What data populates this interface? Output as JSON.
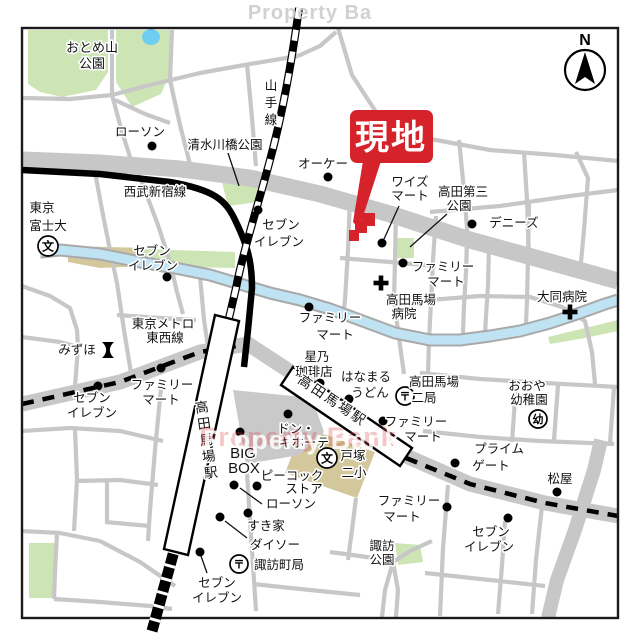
{
  "map": {
    "canvas": {
      "w": 640,
      "h": 640,
      "bg": "#ffffff"
    },
    "frame": {
      "x": 22,
      "y": 28,
      "w": 596,
      "h": 590,
      "stroke": "#1a1a1a",
      "sw": 2.4
    },
    "colors": {
      "road": "#c7c7c7",
      "park": "#cde4b5",
      "pond": "#6ecef2",
      "water": "#bfe3f2",
      "water_casing": "#a9a9a9",
      "tan": "#d2c89c",
      "plaza": "#c9c9c9",
      "rail": "#000000",
      "site_red": "#d6232b",
      "text": "#111111",
      "watermark_gray": "#c9c9c9",
      "watermark_red": "#e0474d"
    },
    "watermarks": {
      "top": "Property Ba",
      "center": "Property Bank"
    },
    "compass": {
      "label": "N",
      "cx": 585,
      "cy": 70,
      "r": 20,
      "arrow": "585,52 595,84 585,77 575,84",
      "label_y": 45
    },
    "parks": [
      {
        "name": "otomeyama-park-west",
        "pts": "28,30 108,30 108,72 96,90 62,97 40,92 28,84"
      },
      {
        "name": "otomeyama-park-east",
        "pts": "116,30 172,30 172,68 161,94 132,107 116,82"
      },
      {
        "name": "shimizugawabashi-park",
        "pts": "222,182 256,178 258,202 228,206"
      },
      {
        "name": "takada-daisan-park",
        "pts": "394,238 414,238 414,258 394,258"
      },
      {
        "name": "suwa-park",
        "pts": "395,543 420,545 423,562 398,565"
      },
      {
        "name": "southwest-green",
        "pts": "29,543 56,543 56,598 29,598"
      },
      {
        "name": "river-bank-green-west",
        "pts": "143,249 235,252 235,268 143,266"
      },
      {
        "name": "river-bank-green-east",
        "pts": "548,337 585,328 618,320 618,331 585,338 550,344"
      }
    ],
    "tans": [
      {
        "name": "tokyo-fuji-univ-grounds",
        "pts": "68,246 145,248 145,266 100,268 68,262"
      },
      {
        "name": "tozuka-school-grounds",
        "pts": "303,427 375,452 357,498 285,473"
      }
    ],
    "pond": {
      "name": "otomeyama-pond",
      "cx": 151,
      "cy": 37,
      "rx": 9,
      "ry": 8
    },
    "plaza": {
      "name": "station-plaza",
      "pts": "233,390 312,398 324,432 300,455 246,464"
    },
    "roads_major": [
      {
        "name": "road-mejiro-dori",
        "pts": "22,160 100,163 180,169 250,178 320,194 390,214 470,240 550,262 618,281",
        "w": 17
      },
      {
        "name": "road-waseda-dori",
        "pts": "22,404 120,382 200,352 248,344 300,378 355,416 406,456 470,484 545,503 618,516",
        "w": 15
      },
      {
        "name": "road-east-vertical",
        "pts": "601,440 594,470 575,530 557,580 548,618",
        "w": 14
      }
    ],
    "roads_minor": [
      {
        "pts": "22,98 70,99 112,95 150,85 200,73 250,64 298,56"
      },
      {
        "pts": "112,30 112,95 122,132 133,166"
      },
      {
        "pts": "172,30 170,80 180,125 192,172"
      },
      {
        "pts": "115,100 145,114 170,123"
      },
      {
        "pts": "247,64 252,118 256,166"
      },
      {
        "pts": "298,56 320,46 336,32"
      },
      {
        "pts": "338,28 352,75 376,112 425,138 490,150 555,155 618,161"
      },
      {
        "pts": "459,140 464,190 468,240"
      },
      {
        "pts": "524,152 527,200 529,258"
      },
      {
        "pts": "430,212 500,206 570,196 618,190"
      },
      {
        "pts": "576,152 588,178 584,230 581,262"
      },
      {
        "pts": "95,172 103,215 110,250 117,283 124,330 133,385"
      },
      {
        "pts": "138,172 158,225 170,262 177,292 183,314"
      },
      {
        "pts": "117,315 160,318 196,320"
      },
      {
        "pts": "200,276 204,320 210,360 216,390"
      },
      {
        "pts": "22,286 50,296 70,308 77,330 78,347"
      },
      {
        "pts": "22,337 60,342 78,347"
      },
      {
        "pts": "78,347 74,400"
      },
      {
        "pts": "350,198 348,250 345,300 343,316"
      },
      {
        "pts": "396,210 395,260 394,300 399,338 404,374"
      },
      {
        "pts": "436,216 433,260 431,302 429,340 428,374"
      },
      {
        "pts": "467,240 466,272 464,305 463,333"
      },
      {
        "pts": "489,248 488,285 486,316 485,334"
      },
      {
        "pts": "529,200 528,256 527,300 526,324"
      },
      {
        "pts": "340,258 390,262 436,266"
      },
      {
        "pts": "430,300 480,296 530,297 562,307 585,321 592,352 595,384"
      },
      {
        "pts": "420,373 480,379 545,383 618,387"
      },
      {
        "pts": "516,385 512,442"
      },
      {
        "pts": "558,385 554,440"
      },
      {
        "pts": "423,431 480,437 540,441 614,444"
      },
      {
        "pts": "614,388 610,443"
      },
      {
        "pts": "448,485 443,548 440,616"
      },
      {
        "pts": "505,521 502,565 498,614"
      },
      {
        "pts": "425,573 490,580 545,586"
      },
      {
        "pts": "542,506 536,560 532,614"
      },
      {
        "pts": "330,552 360,556 392,561"
      },
      {
        "pts": "432,541 410,551 393,562 385,590 382,617"
      },
      {
        "pts": "393,562 398,590 396,617"
      },
      {
        "pts": "22,431 70,428 120,431 163,441"
      },
      {
        "pts": "75,429 77,480 74,531"
      },
      {
        "pts": "76,481 120,480 158,485"
      },
      {
        "pts": "107,481 107,522"
      },
      {
        "pts": "105,522 150,526"
      },
      {
        "pts": "22,531 60,533 100,541"
      },
      {
        "pts": "100,541 140,562 175,586"
      },
      {
        "pts": "57,533 55,572 54,599"
      },
      {
        "pts": "54,599 100,602 150,606 172,609"
      },
      {
        "pts": "161,388 155,450 150,510 148,541"
      },
      {
        "pts": "247,472 250,520 253,565 256,611"
      },
      {
        "pts": "253,584 310,590 360,595"
      },
      {
        "pts": "356,498 352,530 348,560"
      }
    ],
    "river": {
      "name": "kanda-river",
      "pts": "40,252 60,250 100,254 140,262 180,269 210,275 240,284 270,293 300,300 330,309 360,320 395,333 430,340 460,340 490,336 520,331 550,323 580,313 605,304 618,300",
      "w_fill": 9,
      "w_casing": 13
    },
    "rails": {
      "seibu": {
        "name": "seibu-shinjuku-line",
        "path": "M22,170 L100,174 L170,182 C215,190 226,200 236,222 C248,247 252,262 252,288 L248,330 L244,367",
        "w": 6.5
      },
      "yamanote": {
        "name": "yamanote-line",
        "path": "M299,8 C292,60 283,112 270,160 C258,205 243,252 236,288 L229,318",
        "w": 8
      },
      "platform": {
        "name": "jr-platform",
        "path": "M174,551 L152,631",
        "w": 11
      },
      "tozai_dashes": [
        "M22,404 L120,382 L200,352 L243,345",
        "M406,458 L470,484 L545,503 L618,516"
      ]
    },
    "stations": {
      "jr_box": {
        "name": "jr-takadanobaba-station",
        "pts": "215,315 239,321 188,555 164,549"
      },
      "tozai_box": {
        "name": "tozai-takadanobaba-station",
        "pts": "281,385 293,367 412,448 400,466"
      },
      "jr_label": {
        "name": "jr-station-label",
        "text": "高田馬場駅",
        "x": 201,
        "y0": 412,
        "dy": 16.5,
        "rot": [
          -8,
          201,
          402
        ],
        "s": 13.5
      },
      "tozai_label": {
        "name": "tozai-station-label",
        "text": "高田馬場駅",
        "x": 297,
        "y": 382,
        "rot": [
          34,
          297,
          382
        ],
        "ls": 2.5,
        "s": 13.5
      }
    },
    "site": {
      "label": "現地",
      "balloon": {
        "x": 350,
        "y": 110,
        "w": 83,
        "h": 53,
        "r": 7
      },
      "text_pos": [
        391,
        149
      ],
      "pointer": "363,161 381,161 359,229 353,222",
      "footprint": "M375,213 L375,226 L367,226 L367,233 L359,233 L359,241 L349,241 L349,230 L355,230 L355,221 L362,221 L362,213 Z"
    },
    "leaders": [
      {
        "name": "leader-shimizugawabashi",
        "x1": 228,
        "y1": 153,
        "x2": 239,
        "y2": 186
      },
      {
        "name": "leader-takada-daisan",
        "x1": 447,
        "y1": 214,
        "x2": 410,
        "y2": 247
      },
      {
        "name": "leader-ys-mart",
        "x1": 399,
        "y1": 206,
        "x2": 384,
        "y2": 239
      },
      {
        "name": "leader-lawson-south",
        "x1": 262,
        "y1": 504,
        "x2": 240,
        "y2": 488
      },
      {
        "name": "leader-daiso",
        "x1": 225,
        "y1": 521,
        "x2": 247,
        "y2": 538
      },
      {
        "name": "leader-seven-south",
        "x1": 201,
        "y1": 556,
        "x2": 207,
        "y2": 573
      }
    ],
    "dots": [
      {
        "name": "poi-lawson-north",
        "x": 152,
        "y": 146
      },
      {
        "name": "poi-ok-store",
        "x": 328,
        "y": 177
      },
      {
        "name": "poi-seven-eleven-mid",
        "x": 258,
        "y": 210
      },
      {
        "name": "poi-dennys",
        "x": 472,
        "y": 224
      },
      {
        "name": "poi-ys-mart",
        "x": 382,
        "y": 243
      },
      {
        "name": "poi-familymart-ne",
        "x": 403,
        "y": 263
      },
      {
        "name": "poi-seven-eleven-west",
        "x": 167,
        "y": 277
      },
      {
        "name": "poi-familymart-river",
        "x": 309,
        "y": 307
      },
      {
        "name": "poi-familymart-west",
        "x": 161,
        "y": 368
      },
      {
        "name": "poi-seven-eleven-sw",
        "x": 98,
        "y": 386
      },
      {
        "name": "poi-hoshino-coffee",
        "x": 320,
        "y": 383
      },
      {
        "name": "poi-hanamaru-udon",
        "x": 349,
        "y": 399
      },
      {
        "name": "poi-don-quijote",
        "x": 288,
        "y": 414
      },
      {
        "name": "poi-familymart-mid",
        "x": 383,
        "y": 421
      },
      {
        "name": "poi-big-box",
        "x": 240,
        "y": 432
      },
      {
        "name": "poi-prime-gate",
        "x": 455,
        "y": 463
      },
      {
        "name": "poi-lawson-south",
        "x": 234,
        "y": 485
      },
      {
        "name": "poi-peacock-store",
        "x": 257,
        "y": 486
      },
      {
        "name": "poi-familymart-se",
        "x": 447,
        "y": 507
      },
      {
        "name": "poi-sukiya",
        "x": 248,
        "y": 513
      },
      {
        "name": "poi-daiso",
        "x": 220,
        "y": 517
      },
      {
        "name": "poi-matsuya",
        "x": 557,
        "y": 492
      },
      {
        "name": "poi-seven-eleven-se",
        "x": 508,
        "y": 518
      },
      {
        "name": "poi-seven-eleven-south",
        "x": 200,
        "y": 552
      }
    ],
    "symbols": [
      {
        "type": "school",
        "name": "tokyo-fuji-univ-icon",
        "x": 48,
        "y": 246,
        "r": 10,
        "ch": "文"
      },
      {
        "type": "school",
        "name": "tozuka-elementary-icon",
        "x": 327,
        "y": 458,
        "r": 10,
        "ch": "文"
      },
      {
        "type": "post",
        "name": "takadanobaba-2-post-icon",
        "x": 405,
        "y": 396,
        "r": 9,
        "ch": "〒"
      },
      {
        "type": "post",
        "name": "suwacho-post-icon",
        "x": 239,
        "y": 564,
        "r": 9,
        "ch": "〒"
      },
      {
        "type": "kindergarten",
        "name": "ooya-kindergarten-icon",
        "x": 538,
        "y": 419,
        "r": 9,
        "ch": "幼"
      },
      {
        "type": "hospital",
        "name": "takadanobaba-hospital-icon",
        "x": 381,
        "y": 283
      },
      {
        "type": "hospital",
        "name": "daido-hospital-icon",
        "x": 570,
        "y": 312
      },
      {
        "type": "bank",
        "name": "mizuho-bank-icon",
        "x": 108,
        "y": 350
      }
    ],
    "labels": [
      {
        "name": "label-otomeyama-1",
        "text": "おとめ山",
        "x": 92,
        "y": 52,
        "s": 13
      },
      {
        "name": "label-otomeyama-2",
        "text": "公園",
        "x": 92,
        "y": 68,
        "s": 13
      },
      {
        "name": "label-lawson-north",
        "text": "ローソン",
        "x": 140,
        "y": 136
      },
      {
        "name": "label-shimizugawabashi",
        "text": "清水川橋公園",
        "x": 225,
        "y": 149
      },
      {
        "name": "label-yamanote-line",
        "text": "山手線",
        "x": 271,
        "y": 90,
        "vert": true,
        "dy": 17
      },
      {
        "name": "label-seibu-line",
        "text": "西武新宿線",
        "x": 155,
        "y": 196
      },
      {
        "name": "label-ok-store",
        "text": "オーケー",
        "x": 323,
        "y": 168
      },
      {
        "name": "label-ys-mart-1",
        "text": "ワイズ",
        "x": 410,
        "y": 186
      },
      {
        "name": "label-ys-mart-2",
        "text": "マート",
        "x": 410,
        "y": 200
      },
      {
        "name": "label-takada-daisan-1",
        "text": "高田第三",
        "x": 463,
        "y": 196
      },
      {
        "name": "label-takada-daisan-2",
        "text": "公園",
        "x": 459,
        "y": 210
      },
      {
        "name": "label-dennys",
        "text": "デニーズ",
        "x": 514,
        "y": 227
      },
      {
        "name": "label-seven-mid-1",
        "text": "セブン",
        "x": 281,
        "y": 229
      },
      {
        "name": "label-seven-mid-2",
        "text": "イレブン",
        "x": 279,
        "y": 246
      },
      {
        "name": "label-familymart-ne-1",
        "text": "ファミリー",
        "x": 443,
        "y": 271
      },
      {
        "name": "label-familymart-ne-2",
        "text": "マート",
        "x": 446,
        "y": 286
      },
      {
        "name": "label-baba-hospital-1",
        "text": "高田馬場",
        "x": 411,
        "y": 304
      },
      {
        "name": "label-baba-hospital-2",
        "text": "病院",
        "x": 404,
        "y": 318
      },
      {
        "name": "label-daido-hospital",
        "text": "大同病院",
        "x": 562,
        "y": 301
      },
      {
        "name": "label-tokyo-fuji-1",
        "text": "東京",
        "x": 42,
        "y": 212
      },
      {
        "name": "label-tokyo-fuji-2",
        "text": "富士大",
        "x": 48,
        "y": 230
      },
      {
        "name": "label-seven-west-1",
        "text": "セブン",
        "x": 152,
        "y": 255
      },
      {
        "name": "label-seven-west-2",
        "text": "イレブン",
        "x": 153,
        "y": 270
      },
      {
        "name": "label-tozai-line-1",
        "text": "東京メトロ",
        "x": 163,
        "y": 328
      },
      {
        "name": "label-tozai-line-2",
        "text": "東西線",
        "x": 165,
        "y": 342
      },
      {
        "name": "label-mizuho",
        "text": "みずほ",
        "x": 77,
        "y": 354
      },
      {
        "name": "label-familymart-river-1",
        "text": "ファミリー",
        "x": 330,
        "y": 322
      },
      {
        "name": "label-familymart-river-2",
        "text": "マート",
        "x": 335,
        "y": 339
      },
      {
        "name": "label-familymart-west-1",
        "text": "ファミリー",
        "x": 162,
        "y": 389
      },
      {
        "name": "label-familymart-west-2",
        "text": "マート",
        "x": 161,
        "y": 404
      },
      {
        "name": "label-seven-sw-1",
        "text": "セブン",
        "x": 92,
        "y": 402
      },
      {
        "name": "label-seven-sw-2",
        "text": "イレブン",
        "x": 92,
        "y": 417
      },
      {
        "name": "label-hoshino-1",
        "text": "星乃",
        "x": 317,
        "y": 361
      },
      {
        "name": "label-hoshino-2",
        "text": "珈琲店",
        "x": 314,
        "y": 376
      },
      {
        "name": "label-hanamaru-1",
        "text": "はなまる",
        "x": 366,
        "y": 381
      },
      {
        "name": "label-hanamaru-2",
        "text": "うどん",
        "x": 370,
        "y": 397
      },
      {
        "name": "label-baba2-post-1",
        "text": "高田馬場",
        "x": 434,
        "y": 386
      },
      {
        "name": "label-baba2-post-2",
        "text": "二局",
        "x": 424,
        "y": 402
      },
      {
        "name": "label-ooya-1",
        "text": "おおや",
        "x": 527,
        "y": 390
      },
      {
        "name": "label-ooya-2",
        "text": "幼稚園",
        "x": 529,
        "y": 404
      },
      {
        "name": "label-donki-1",
        "text": "ドン・",
        "x": 296,
        "y": 433
      },
      {
        "name": "label-donki-2",
        "text": "キホーテ",
        "x": 304,
        "y": 447
      },
      {
        "name": "label-bigbox-1",
        "text": "BIG",
        "x": 243,
        "y": 458,
        "s": 15
      },
      {
        "name": "label-bigbox-2",
        "text": "BOX",
        "x": 244,
        "y": 473,
        "s": 15
      },
      {
        "name": "label-peacock-1",
        "text": "ピーコック",
        "x": 292,
        "y": 480
      },
      {
        "name": "label-peacock-2",
        "text": "ストア",
        "x": 304,
        "y": 493
      },
      {
        "name": "label-lawson-south",
        "text": "ローソン",
        "x": 291,
        "y": 508
      },
      {
        "name": "label-sukiya",
        "text": "すき家",
        "x": 266,
        "y": 530
      },
      {
        "name": "label-daiso",
        "text": "ダイソー",
        "x": 275,
        "y": 549
      },
      {
        "name": "label-suwacho-post",
        "text": "諏訪町局",
        "x": 279,
        "y": 569
      },
      {
        "name": "label-seven-south-1",
        "text": "セブン",
        "x": 217,
        "y": 587
      },
      {
        "name": "label-seven-south-2",
        "text": "イレブン",
        "x": 217,
        "y": 602
      },
      {
        "name": "label-tozuka-1",
        "text": "戸塚",
        "x": 353,
        "y": 460
      },
      {
        "name": "label-tozuka-2",
        "text": "二小",
        "x": 354,
        "y": 477
      },
      {
        "name": "label-familymart-mid-1",
        "text": "ファミリー",
        "x": 416,
        "y": 426
      },
      {
        "name": "label-familymart-mid-2",
        "text": "マート",
        "x": 423,
        "y": 441
      },
      {
        "name": "label-prime-1",
        "text": "プライム",
        "x": 499,
        "y": 453
      },
      {
        "name": "label-prime-2",
        "text": "ゲート",
        "x": 491,
        "y": 470
      },
      {
        "name": "label-familymart-se-1",
        "text": "ファミリー",
        "x": 409,
        "y": 505
      },
      {
        "name": "label-familymart-se-2",
        "text": "マート",
        "x": 402,
        "y": 521
      },
      {
        "name": "label-seven-se-1",
        "text": "セブン",
        "x": 491,
        "y": 536
      },
      {
        "name": "label-seven-se-2",
        "text": "イレブン",
        "x": 489,
        "y": 551
      },
      {
        "name": "label-matsuya",
        "text": "松屋",
        "x": 560,
        "y": 483
      },
      {
        "name": "label-suwa-park-1",
        "text": "諏訪",
        "x": 382,
        "y": 550
      },
      {
        "name": "label-suwa-park-2",
        "text": "公園",
        "x": 382,
        "y": 564
      }
    ]
  }
}
